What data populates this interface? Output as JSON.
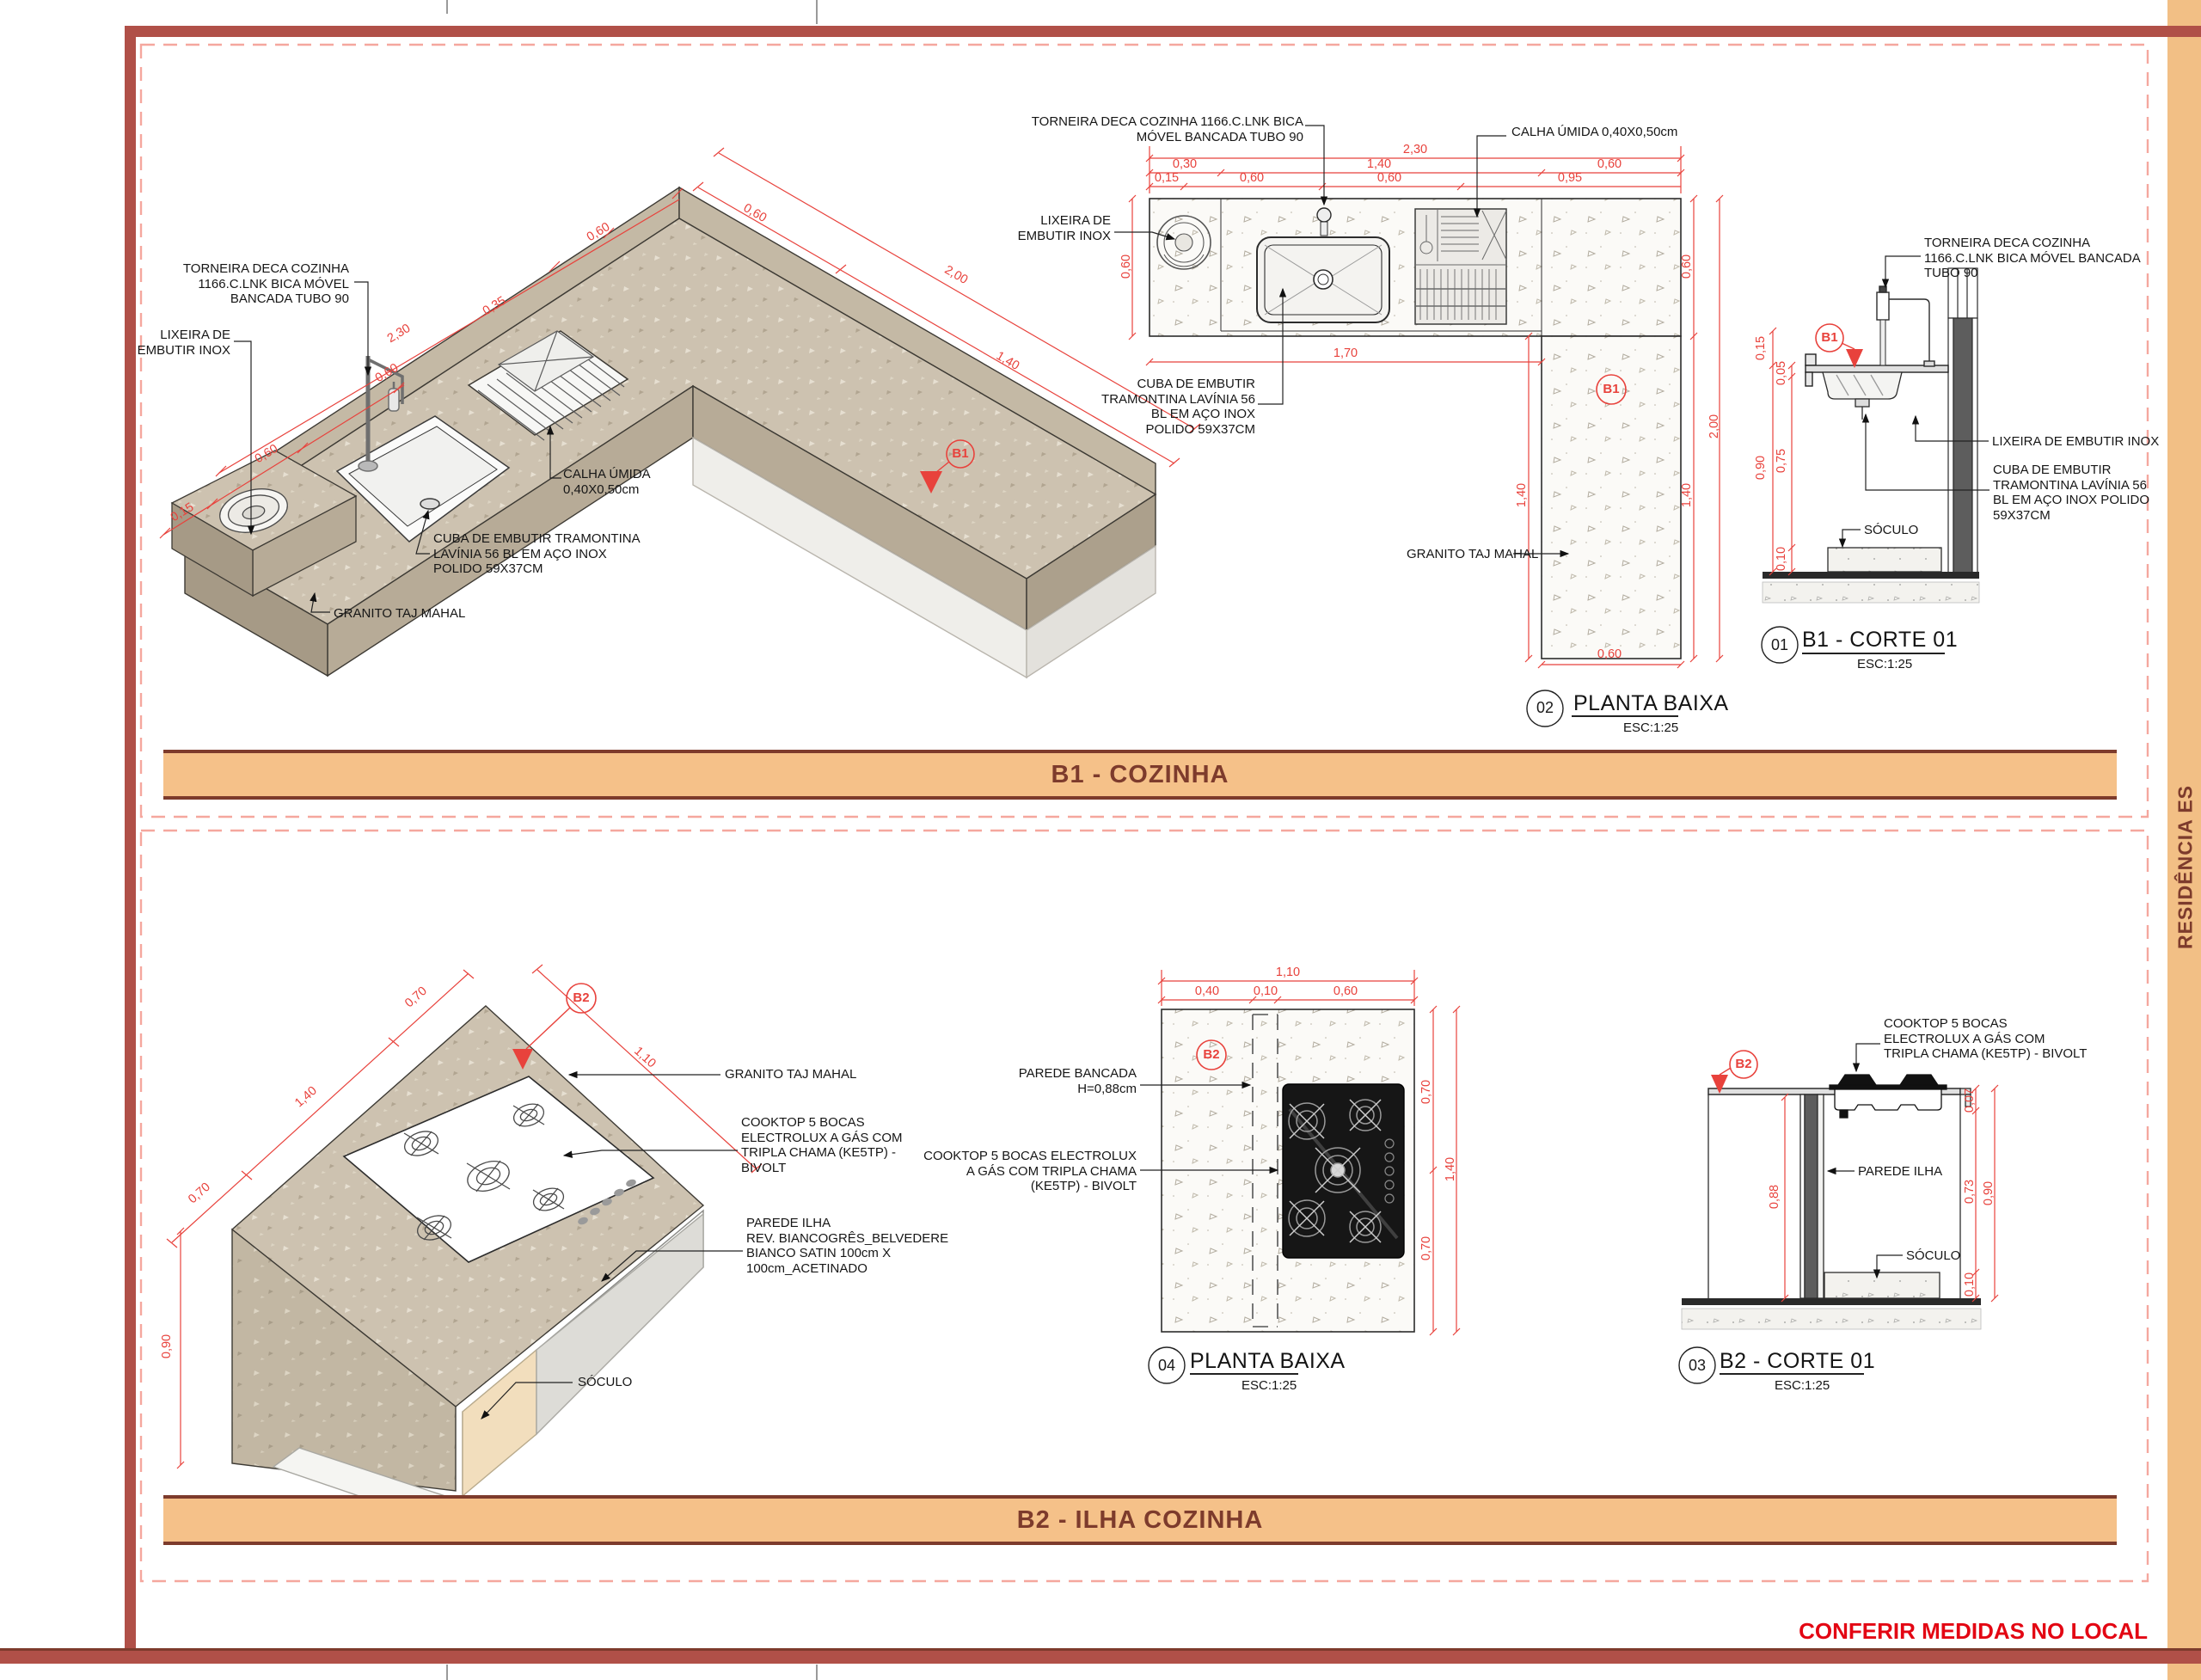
{
  "sheet": {
    "project": "RESIDÊNCIA ES",
    "note": "CONFERIR MEDIDAS NO LOCAL",
    "colors": {
      "border": "#b05048",
      "banner": "#f5c189",
      "banner_text": "#7d3b2c",
      "dim_red": "#e8423c",
      "note_red": "#e30613",
      "granite": "#cdc2b0"
    }
  },
  "b1": {
    "banner": "B1 -  COZINHA",
    "iso": {
      "labels": {
        "torneira": "TORNEIRA DECA COZINHA\n1166.C.LNK BICA MÓVEL\nBANCADA TUBO 90",
        "lixeira": "LIXEIRA DE\nEMBUTIR INOX",
        "calha": "CALHA ÚMIDA\n0,40X0,50cm",
        "cuba": "CUBA DE EMBUTIR TRAMONTINA\nLAVÍNIA 56 BL EM AÇO INOX\nPOLIDO 59X37CM",
        "granito": "GRANITO TAJ MAHAL"
      },
      "marker": "B1",
      "dims": [
        "0,15",
        "0,60",
        "0,60",
        "2,30",
        "0,35",
        "0,60",
        "0,60",
        "1,40",
        "2,00"
      ]
    },
    "plan": {
      "labels": {
        "torneira": "TORNEIRA DECA COZINHA 1166.C.LNK BICA\nMÓVEL BANCADA TUBO 90",
        "calha": "CALHA ÚMIDA 0,40X0,50cm",
        "lixeira": "LIXEIRA DE\nEMBUTIR INOX",
        "cuba": "CUBA DE EMBUTIR\nTRAMONTINA LAVÍNIA 56\nBL EM AÇO INOX\nPOLIDO 59X37CM",
        "granito": "GRANITO TAJ MAHAL"
      },
      "marker": "B1",
      "dims": [
        "2,30",
        "0,30",
        "1,40",
        "0,60",
        "0,15",
        "0,60",
        "0,60",
        "0,95",
        "0,60",
        "1,70",
        "1,40",
        "0,60",
        "1,40",
        "2,00",
        "0,60"
      ],
      "title_num": "02",
      "title": "PLANTA BAIXA",
      "scale": "ESC:1:25"
    },
    "corte": {
      "labels": {
        "torneira": "TORNEIRA DECA COZINHA\n1166.C.LNK BICA MÓVEL BANCADA\nTUBO 90",
        "lixeira": "LIXEIRA DE EMBUTIR INOX",
        "cuba": "CUBA DE EMBUTIR\nTRAMONTINA LAVÍNIA 56\nBL EM AÇO INOX POLIDO\n59X37CM",
        "soculo": "SÓCULO"
      },
      "marker": "B1",
      "dims": [
        "0,15",
        "0,05",
        "0,90",
        "0,75",
        "0,10"
      ],
      "title_num": "01",
      "title": "B1 -  CORTE 01",
      "scale": "ESC:1:25"
    }
  },
  "b2": {
    "banner": "B2 -  ILHA COZINHA",
    "iso": {
      "labels": {
        "granito": "GRANITO TAJ MAHAL",
        "cooktop": "COOKTOP 5 BOCAS\nELECTROLUX A GÁS COM\nTRIPLA CHAMA (KE5TP) -\nBIVOLT",
        "parede": "PAREDE ILHA\nREV. BIANCOGRÊS_BELVEDERE\nBIANCO SATIN 100cm X\n100cm_ACETINADO",
        "soculo": "SÓCULO"
      },
      "marker": "B2",
      "dims": [
        "0,70",
        "1,40",
        "0,70",
        "1,10",
        "0,90"
      ]
    },
    "plan": {
      "labels": {
        "parede": "PAREDE BANCADA\nH=0,88cm",
        "cooktop": "COOKTOP 5 BOCAS ELECTROLUX\nA GÁS COM TRIPLA CHAMA\n(KE5TP) - BIVOLT"
      },
      "marker": "B2",
      "dims": [
        "1,10",
        "0,40",
        "0,10",
        "0,60",
        "0,70",
        "1,40",
        "0,70"
      ],
      "title_num": "04",
      "title": "PLANTA BAIXA",
      "scale": "ESC:1:25"
    },
    "corte": {
      "labels": {
        "cooktop": "COOKTOP 5 BOCAS\nELECTROLUX A GÁS COM\nTRIPLA CHAMA (KE5TP) - BIVOLT",
        "parede": "PAREDE ILHA",
        "soculo": "SÓCULO"
      },
      "marker": "B2",
      "dims": [
        "0,88",
        "0,07",
        "0,73",
        "0,90",
        "0,10"
      ],
      "title_num": "03",
      "title": "B2 -  CORTE 01",
      "scale": "ESC:1:25"
    }
  }
}
